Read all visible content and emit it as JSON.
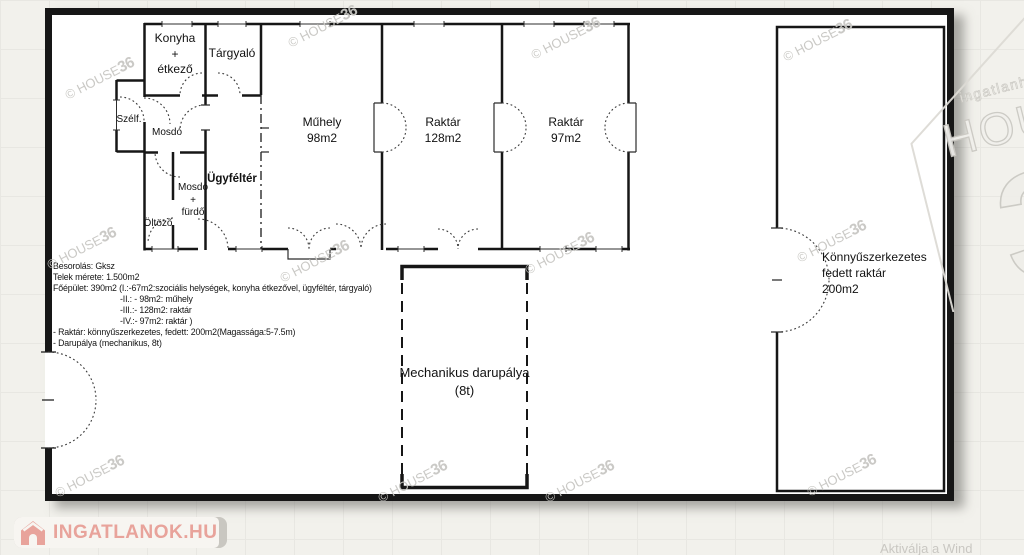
{
  "plan": {
    "rooms": {
      "konyha": {
        "line1": "Konyha",
        "line2": "+",
        "line3": "étkező"
      },
      "targyalo": {
        "label": "Tárgyaló"
      },
      "szelfogo": {
        "label": "Szélf."
      },
      "mosdo": {
        "label": "Mosdó"
      },
      "mosdo_furdo": {
        "line1": "Mosdó",
        "line2": "+",
        "line3": "fürdő"
      },
      "oltozo": {
        "label": "Öltöző"
      },
      "ugyfelter": {
        "label": "Ügyféltér"
      },
      "muhely": {
        "line1": "Műhely",
        "line2": "98m2"
      },
      "raktar_128": {
        "line1": "Raktár",
        "line2": "128m2"
      },
      "raktar_97": {
        "line1": "Raktár",
        "line2": "97m2"
      },
      "fedett_raktar": {
        "line1": "Könnyűszerkezetes",
        "line2": "fedett raktár",
        "line3": "200m2"
      },
      "darupalya": {
        "line1": "Mechanikus darupálya",
        "line2": "(8t)"
      }
    },
    "notes": [
      {
        "text": "Besorolás: Gksz",
        "indent": false
      },
      {
        "text": "Telek mérete: 1.500m2",
        "indent": false
      },
      {
        "text": "Főépület: 390m2 (I.:-67m2:szociális helységek, konyha étkezővel, ügyféltér, tárgyaló)",
        "indent": false
      },
      {
        "text": "-II.: - 98m2: műhely",
        "indent": true
      },
      {
        "text": "-III.:- 128m2: raktár",
        "indent": true
      },
      {
        "text": "-IV.:- 97m2: raktár )",
        "indent": true
      },
      {
        "text": "- Raktár: könnyűszerkezetes, fedett: 200m2(Magassága:5-7.5m)",
        "indent": false
      },
      {
        "text": "- Darupálya (mechanikus, 8t)",
        "indent": false
      }
    ]
  },
  "watermark": {
    "prefix": "© HOUSE",
    "suffix": "36",
    "color": "#c8c7c3",
    "positions": [
      [
        62,
        70
      ],
      [
        285,
        18
      ],
      [
        528,
        30
      ],
      [
        780,
        32
      ],
      [
        44,
        240
      ],
      [
        277,
        253
      ],
      [
        522,
        245
      ],
      [
        794,
        233
      ],
      [
        52,
        468
      ],
      [
        375,
        473
      ],
      [
        542,
        473
      ],
      [
        804,
        467
      ]
    ]
  },
  "brand_logo": {
    "tagline": "ingatlanhálózat",
    "name": "HOUSE",
    "number": "36"
  },
  "footer_logo": {
    "text": "INGATLANOK.HU",
    "accent": "#e8a39b"
  },
  "system_hint": "Aktiválja a Wind"
}
